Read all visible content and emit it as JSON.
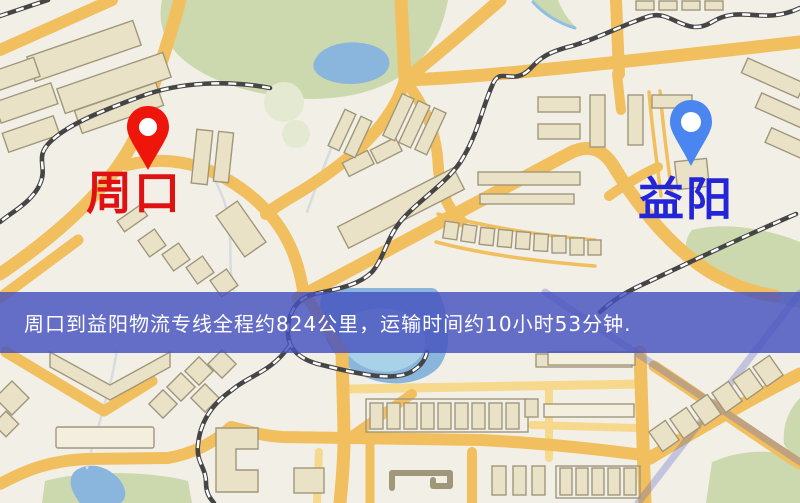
{
  "banner": {
    "text": "周口到益阳物流专线全程约824公里，运输时间约10小时53分钟.",
    "background": "rgba(70,82,190,0.82)",
    "text_color": "#ffffff"
  },
  "markers": {
    "origin": {
      "label": "周口",
      "pin_color": "#ee150b",
      "label_color": "#e01111"
    },
    "destination": {
      "label": "益阳",
      "pin_color": "#4b86f0",
      "label_color": "#2525d8"
    }
  },
  "map_palette": {
    "background": "#f2efe7",
    "road_major": "#f1bf5e",
    "road_minor": "#f6d98d",
    "building_fill": "#eae2c6",
    "building_light": "#f3eedd",
    "building_stroke": "#a0977b",
    "park": "#ccd8ad",
    "park_light": "#e3ead1",
    "water": "#8ab5dc",
    "water_light": "#a9d2e8",
    "railway_dark": "#454545",
    "railway_dash": "#ffffff",
    "expressway": "#5560cc",
    "stream": "#d8dce0",
    "river": "#8fc0e4"
  }
}
